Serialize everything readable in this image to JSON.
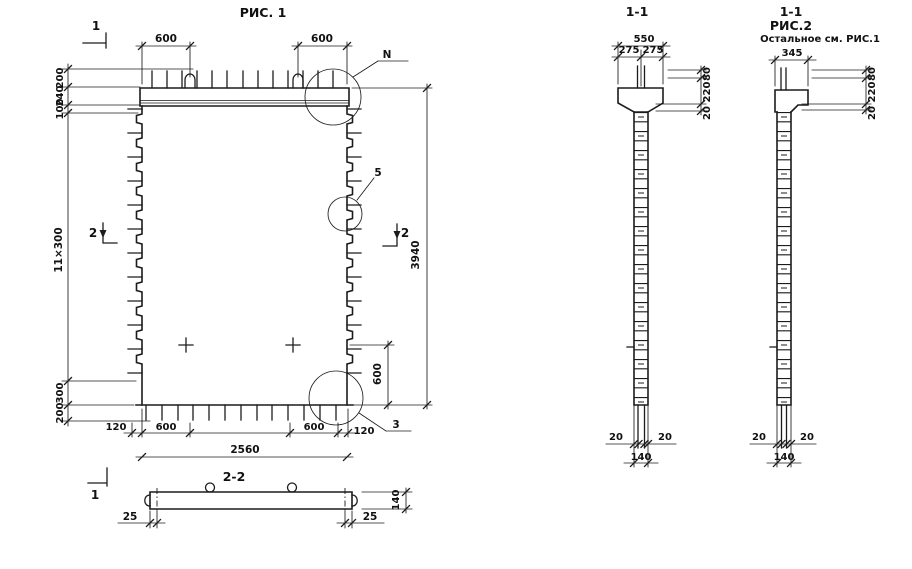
{
  "fig1": {
    "title": "РИС. 1",
    "marks": {
      "one_top": "1",
      "one_bottom": "1",
      "two_left": "2",
      "two_right": "2"
    },
    "callouts": {
      "n": "N",
      "five": "5",
      "three": "3"
    },
    "dims": {
      "top_left": "600",
      "top_right": "600",
      "left_200_top": "200",
      "left_240": "240",
      "left_100": "100",
      "left_pitch": "11×300",
      "left_300": "300",
      "left_200_bottom": "200",
      "height_total": "3940",
      "right_600": "600",
      "bottom_120_left": "120",
      "bottom_600_left": "600",
      "bottom_600_right": "600",
      "bottom_120_right": "120",
      "width_total": "2560"
    }
  },
  "sec22": {
    "title": "2-2",
    "dims": {
      "left_25": "25",
      "right_25": "25",
      "thickness_140": "140"
    }
  },
  "sec11": {
    "title": "1-1",
    "dims": {
      "width_550": "550",
      "half_275_left": "275",
      "half_275_right": "275",
      "right_80": "80",
      "right_220": "220",
      "right_20": "20",
      "bottom_20_left": "20",
      "bottom_20_right": "20",
      "bottom_140": "140"
    }
  },
  "fig2": {
    "title": "1-1",
    "subtitle": "РИС.2",
    "note": "Остальное см. РИС.1",
    "dims": {
      "width_345": "345",
      "right_80": "80",
      "right_220": "220",
      "right_20": "20",
      "bottom_20_left": "20",
      "bottom_20_right": "20",
      "bottom_140": "140"
    }
  }
}
